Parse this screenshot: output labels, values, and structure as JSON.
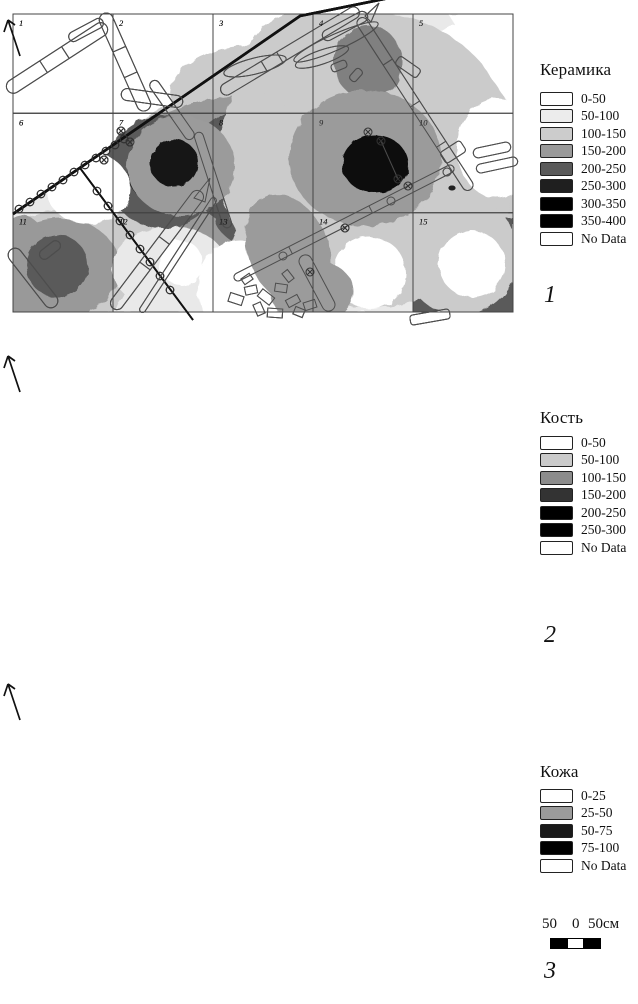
{
  "figure": {
    "grid": {
      "cols": 5,
      "rows": 3,
      "cell_numbers": [
        "1",
        "2",
        "3",
        "4",
        "5",
        "6",
        "7",
        "8",
        "9",
        "10",
        "11",
        "12",
        "13",
        "14",
        "15"
      ]
    },
    "panels": [
      {
        "id": "ceramics",
        "number": "1",
        "legend_title": "Керамика",
        "legend": [
          {
            "label": "0-50",
            "color": "#ffffff"
          },
          {
            "label": "50-100",
            "color": "#ececec"
          },
          {
            "label": "100-150",
            "color": "#cccccc"
          },
          {
            "label": "150-200",
            "color": "#999999"
          },
          {
            "label": "200-250",
            "color": "#5a5a5a"
          },
          {
            "label": "250-300",
            "color": "#1f1f1f"
          },
          {
            "label": "300-350",
            "color": "#000000"
          },
          {
            "label": "350-400",
            "color": "#000000"
          },
          {
            "label": "No Data",
            "color": "#ffffff"
          }
        ],
        "blobs": [
          {
            "t": "poly",
            "pts": "389,0 513,0 513,312 13,312 13,214 300,16",
            "c": "#e9e9e9"
          },
          {
            "t": "e",
            "x": 255,
            "y": 95,
            "rx": 85,
            "ry": 50,
            "c": "#cbcbcb"
          },
          {
            "t": "e",
            "x": 290,
            "y": 195,
            "rx": 195,
            "ry": 115,
            "c": "#cbcbcb"
          },
          {
            "t": "e",
            "x": 60,
            "y": 270,
            "rx": 70,
            "ry": 60,
            "c": "#cbcbcb"
          },
          {
            "t": "e",
            "x": 480,
            "y": 250,
            "rx": 55,
            "ry": 75,
            "c": "#cbcbcb"
          },
          {
            "t": "e",
            "x": 355,
            "y": 65,
            "rx": 75,
            "ry": 52,
            "c": "#999999"
          },
          {
            "t": "e",
            "x": 340,
            "y": 140,
            "rx": 120,
            "ry": 75,
            "c": "#999999"
          },
          {
            "t": "e",
            "x": 255,
            "y": 170,
            "rx": 135,
            "ry": 75,
            "c": "#999999"
          },
          {
            "t": "e",
            "x": 430,
            "y": 185,
            "rx": 55,
            "ry": 45,
            "c": "#999999"
          },
          {
            "t": "e",
            "x": 300,
            "y": 240,
            "rx": 110,
            "ry": 55,
            "c": "#999999"
          },
          {
            "t": "e",
            "x": 60,
            "y": 268,
            "rx": 60,
            "ry": 50,
            "c": "#999999"
          },
          {
            "t": "e",
            "x": 22,
            "y": 270,
            "rx": 30,
            "ry": 55,
            "c": "#999999"
          },
          {
            "t": "e",
            "x": 170,
            "y": 268,
            "rx": 58,
            "ry": 42,
            "c": "#e9e9e9"
          },
          {
            "t": "e",
            "x": 480,
            "y": 148,
            "rx": 45,
            "ry": 58,
            "c": "#e9e9e9"
          },
          {
            "t": "e",
            "x": 357,
            "y": 70,
            "rx": 48,
            "ry": 45,
            "c": "#5a5a5a"
          },
          {
            "t": "e",
            "x": 350,
            "y": 165,
            "rx": 80,
            "ry": 68,
            "c": "#5a5a5a"
          },
          {
            "t": "e",
            "x": 258,
            "y": 168,
            "rx": 72,
            "ry": 62,
            "c": "#5a5a5a"
          },
          {
            "t": "e",
            "x": 163,
            "y": 172,
            "rx": 58,
            "ry": 56,
            "c": "#5a5a5a"
          },
          {
            "t": "e",
            "x": 300,
            "y": 218,
            "rx": 85,
            "ry": 38,
            "c": "#5a5a5a"
          },
          {
            "t": "c",
            "x": 57,
            "y": 266,
            "r": 31,
            "c": "#5a5a5a"
          },
          {
            "t": "poly",
            "pts": "413,218 513,218 513,312 413,312",
            "c": "#5a5a5a"
          },
          {
            "t": "c",
            "x": 163,
            "y": 170,
            "r": 36,
            "c": "#1f1f1f"
          },
          {
            "t": "c",
            "x": 258,
            "y": 167,
            "r": 40,
            "c": "#1f1f1f"
          },
          {
            "t": "c",
            "x": 357,
            "y": 164,
            "r": 33,
            "c": "#1f1f1f"
          },
          {
            "t": "c",
            "x": 463,
            "y": 267,
            "r": 30,
            "c": "#1f1f1f"
          },
          {
            "t": "c",
            "x": 162,
            "y": 171,
            "r": 27,
            "c": "#000000"
          },
          {
            "t": "c",
            "x": 257,
            "y": 168,
            "r": 31,
            "c": "#000000"
          },
          {
            "t": "c",
            "x": 356,
            "y": 164,
            "r": 25,
            "c": "#000000"
          },
          {
            "t": "c",
            "x": 463,
            "y": 267,
            "r": 25,
            "c": "#000000"
          },
          {
            "t": "e",
            "x": 88,
            "y": 188,
            "rx": 42,
            "ry": 36,
            "c": "#ffffff"
          },
          {
            "t": "c",
            "x": 458,
            "y": 62,
            "r": 36,
            "c": "#ffffff"
          },
          {
            "t": "c",
            "x": 468,
            "y": 177,
            "r": 28,
            "c": "#ffffff"
          },
          {
            "t": "c",
            "x": 181,
            "y": 263,
            "r": 22,
            "c": "#ffffff"
          },
          {
            "t": "e",
            "x": 363,
            "y": 267,
            "rx": 19,
            "ry": 16,
            "c": "#e9e9e9"
          }
        ]
      },
      {
        "id": "bone",
        "number": "2",
        "legend_title": "Кость",
        "legend": [
          {
            "label": "0-50",
            "color": "#ffffff"
          },
          {
            "label": "50-100",
            "color": "#cbcbcb"
          },
          {
            "label": "100-150",
            "color": "#8c8c8c"
          },
          {
            "label": "150-200",
            "color": "#333333"
          },
          {
            "label": "200-250",
            "color": "#000000"
          },
          {
            "label": "250-300",
            "color": "#000000"
          },
          {
            "label": "No Data",
            "color": "#ffffff"
          }
        ],
        "blobs": [
          {
            "t": "e",
            "x": 368,
            "y": 160,
            "rx": 150,
            "ry": 148,
            "c": "#cbcbcb"
          },
          {
            "t": "e",
            "x": 310,
            "y": 60,
            "rx": 62,
            "ry": 50,
            "c": "#cbcbcb"
          },
          {
            "t": "e",
            "x": 170,
            "y": 162,
            "rx": 27,
            "ry": 33,
            "c": "#cbcbcb"
          },
          {
            "t": "e",
            "x": 460,
            "y": 255,
            "rx": 58,
            "ry": 60,
            "c": "#cbcbcb"
          },
          {
            "t": "e",
            "x": 300,
            "y": 255,
            "rx": 70,
            "ry": 60,
            "c": "#cbcbcb"
          },
          {
            "t": "poly",
            "pts": "448,14 513,14 513,110",
            "c": "#ffffff"
          },
          {
            "t": "e",
            "x": 497,
            "y": 148,
            "rx": 40,
            "ry": 50,
            "c": "#ffffff"
          },
          {
            "t": "e",
            "x": 240,
            "y": 288,
            "rx": 42,
            "ry": 48,
            "c": "#ffffff"
          },
          {
            "t": "c",
            "x": 370,
            "y": 273,
            "r": 36,
            "c": "#ffffff"
          },
          {
            "t": "c",
            "x": 472,
            "y": 264,
            "r": 33,
            "c": "#ffffff"
          },
          {
            "t": "e",
            "x": 368,
            "y": 62,
            "rx": 34,
            "ry": 37,
            "c": "#808080"
          },
          {
            "t": "e",
            "x": 366,
            "y": 152,
            "rx": 50,
            "ry": 60,
            "c": "#808080"
          },
          {
            "t": "c",
            "x": 366,
            "y": 170,
            "r": 37,
            "c": "#333333"
          },
          {
            "t": "c",
            "x": 367,
            "y": 172,
            "r": 21,
            "c": "#000000"
          }
        ]
      },
      {
        "id": "leather",
        "number": "3",
        "legend_title": "Кожа",
        "legend": [
          {
            "label": "0-25",
            "color": "#ffffff"
          },
          {
            "label": "25-50",
            "color": "#9b9b9b"
          },
          {
            "label": "50-75",
            "color": "#1a1a1a"
          },
          {
            "label": "75-100",
            "color": "#000000"
          },
          {
            "label": "No Data",
            "color": "#ffffff"
          }
        ],
        "blobs": [
          {
            "t": "e",
            "x": 181,
            "y": 166,
            "rx": 54,
            "ry": 50,
            "c": "#9b9b9b"
          },
          {
            "t": "e",
            "x": 365,
            "y": 158,
            "rx": 76,
            "ry": 68,
            "c": "#9b9b9b"
          },
          {
            "t": "e",
            "x": 288,
            "y": 250,
            "rx": 40,
            "ry": 58,
            "rot": -22,
            "c": "#9b9b9b"
          },
          {
            "t": "e",
            "x": 312,
            "y": 292,
            "rx": 42,
            "ry": 32,
            "c": "#9b9b9b"
          },
          {
            "t": "c",
            "x": 174,
            "y": 163,
            "r": 24,
            "c": "#141414"
          },
          {
            "t": "e",
            "x": 375,
            "y": 164,
            "rx": 33,
            "ry": 29,
            "c": "#0d0d0d"
          }
        ]
      }
    ],
    "scale_bar": {
      "labels": [
        "50",
        "0",
        "50см"
      ],
      "segments": [
        "#000000",
        "#ffffff",
        "#000000"
      ]
    }
  }
}
